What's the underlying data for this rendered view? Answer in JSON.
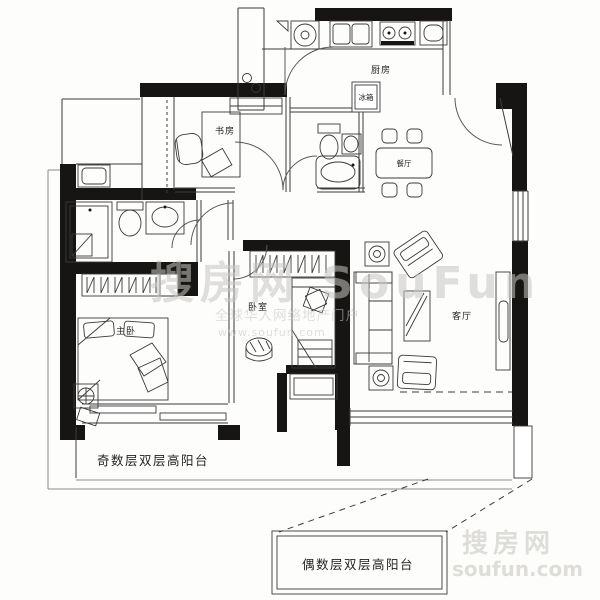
{
  "meta": {
    "paper": "#fdfdfc",
    "wall": "#171513",
    "line": "#3c3c3c",
    "light_line": "#8a8a8a",
    "label_color": "#1f1f1f",
    "watermark_color": "#c7c6c3",
    "watermark_corner_color": "#d9d8d5"
  },
  "rooms": {
    "kitchen": "厨房",
    "fridge": "冰箱",
    "study": "书房",
    "dining": "餐厅",
    "master_bedroom": "主卧",
    "bedroom": "卧室",
    "living_room": "客厅",
    "balcony_odd": "奇数层双层高阳台",
    "balcony_even": "偶数层双层高阳台"
  },
  "watermark": {
    "brand": "搜房网 SouFun",
    "tagline": "全球华人网络地产门户",
    "url": "www.soufun.com",
    "corner_brand": "搜房网",
    "corner_url": "soufun.com"
  }
}
